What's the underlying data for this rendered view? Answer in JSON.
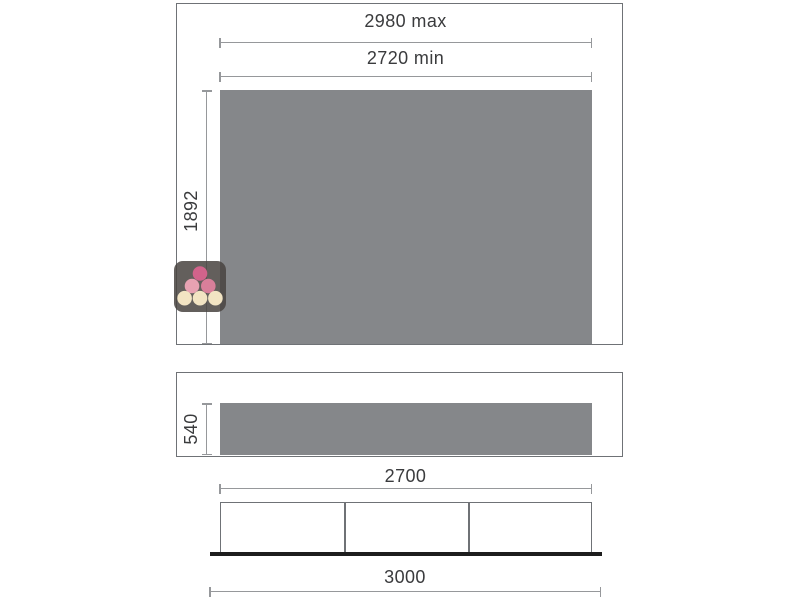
{
  "diagram": {
    "colors": {
      "panel_fill": "#85878a",
      "outline": "#6f7276",
      "dim_line": "#96989b",
      "text": "#3a3b3d",
      "base_line": "#1d1d1d"
    },
    "front_view": {
      "width_max_label": "2980 max",
      "width_min_label": "2720 min",
      "height_label": "1892"
    },
    "side_view": {
      "height_label": "540"
    },
    "base_view": {
      "inner_width_label": "2700",
      "outer_width_label": "3000",
      "section_count": 3
    },
    "logo": {
      "icon": "wine-bottle-caps-logo",
      "tile_color": "rgba(72,67,64,0.85)",
      "dot_colors": {
        "top": "#d2638b",
        "mid_left": "#e7a2b2",
        "mid_right": "#d97f9a",
        "bottom": "#f2e4c3"
      }
    }
  }
}
